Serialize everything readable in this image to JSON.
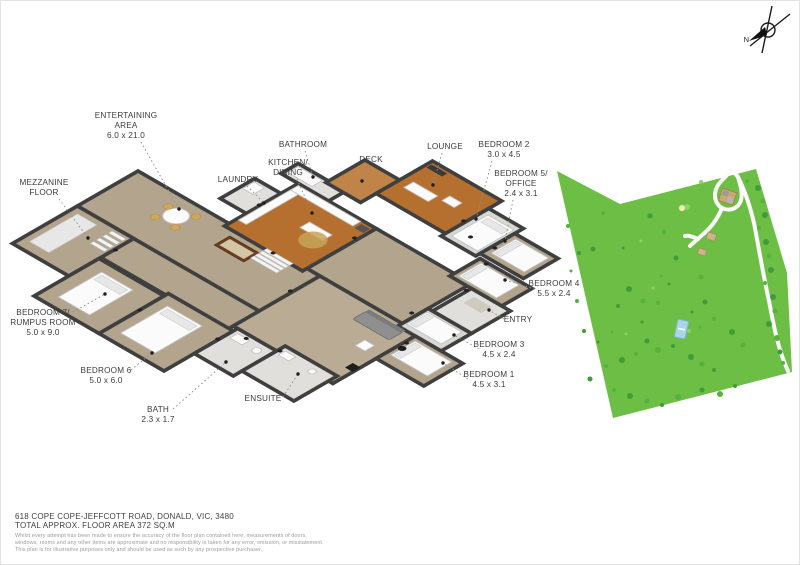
{
  "page": {
    "width": 800,
    "height": 565,
    "background": "#ffffff"
  },
  "compass": {
    "n_label": "N"
  },
  "floor_plan": {
    "labels": [
      {
        "id": "entertaining-area",
        "lines": [
          "ENTERTAINING",
          "AREA",
          "6.0 x 21.0"
        ],
        "x": 125,
        "y": 117,
        "leader": [
          140,
          141,
          178,
          208
        ]
      },
      {
        "id": "mezzanine-floor",
        "lines": [
          "MEZZANINE",
          "FLOOR"
        ],
        "x": 43,
        "y": 184,
        "leader": [
          58,
          198,
          87,
          237
        ]
      },
      {
        "id": "laundry",
        "lines": [
          "LAUNDRY"
        ],
        "x": 237,
        "y": 181,
        "leader": [
          246,
          185,
          263,
          202
        ]
      },
      {
        "id": "bathroom",
        "lines": [
          "BATHROOM"
        ],
        "x": 302,
        "y": 146,
        "leader": [
          304,
          150,
          312,
          176
        ]
      },
      {
        "id": "kitchen-dining",
        "lines": [
          "KITCHEN/",
          "DINING"
        ],
        "x": 287,
        "y": 164,
        "leader": [
          296,
          178,
          311,
          212
        ]
      },
      {
        "id": "deck",
        "lines": [
          "DECK"
        ],
        "x": 370,
        "y": 161,
        "leader": [
          367,
          164,
          361,
          180
        ]
      },
      {
        "id": "lounge",
        "lines": [
          "LOUNGE"
        ],
        "x": 444,
        "y": 148,
        "leader": [
          441,
          152,
          432,
          184
        ]
      },
      {
        "id": "bedroom-2",
        "lines": [
          "BEDROOM 2",
          "3.0 x 4.5"
        ],
        "x": 503,
        "y": 146,
        "leader": [
          491,
          160,
          475,
          218
        ]
      },
      {
        "id": "bedroom-5-office",
        "lines": [
          "BEDROOM 5/",
          "OFFICE",
          "2.4 x 3.1"
        ],
        "x": 520,
        "y": 175,
        "leader": [
          512,
          199,
          504,
          240
        ]
      },
      {
        "id": "bedroom-4",
        "lines": [
          "BEDROOM 4",
          "5.5 x 2.4"
        ],
        "x": 553,
        "y": 285,
        "leader": [
          534,
          288,
          504,
          279
        ]
      },
      {
        "id": "entry",
        "lines": [
          "ENTRY"
        ],
        "x": 517,
        "y": 321,
        "leader": [
          503,
          318,
          488,
          309
        ]
      },
      {
        "id": "bedroom-3",
        "lines": [
          "BEDROOM 3",
          "4.5 x 2.4"
        ],
        "x": 498,
        "y": 346,
        "leader": [
          478,
          348,
          453,
          334
        ]
      },
      {
        "id": "bedroom-1",
        "lines": [
          "BEDROOM 1",
          "4.5 x 3.1"
        ],
        "x": 488,
        "y": 376,
        "leader": [
          467,
          378,
          442,
          362
        ]
      },
      {
        "id": "bedroom-7-rumpus",
        "lines": [
          "BEDROOM 7/",
          "RUMPUS ROOM",
          "5.0 x 9.0"
        ],
        "x": 42,
        "y": 314,
        "leader": [
          72,
          311,
          104,
          293
        ]
      },
      {
        "id": "bedroom-6",
        "lines": [
          "BEDROOM 6",
          "5.0 x 6.0"
        ],
        "x": 105,
        "y": 372,
        "leader": [
          130,
          369,
          151,
          352
        ]
      },
      {
        "id": "bath",
        "lines": [
          "BATH",
          "2.3 x 1.7"
        ],
        "x": 157,
        "y": 411,
        "leader": [
          172,
          408,
          225,
          361
        ]
      },
      {
        "id": "ensuite",
        "lines": [
          "ENSUITE"
        ],
        "x": 262,
        "y": 400,
        "leader": [
          282,
          396,
          297,
          373
        ]
      }
    ],
    "door_markers": [
      [
        208,
        62
      ],
      [
        160,
        34
      ],
      [
        104,
        -6
      ],
      [
        192,
        -28
      ],
      [
        300,
        14
      ],
      [
        327,
        47
      ],
      [
        258,
        -96
      ],
      [
        283,
        -99
      ],
      [
        140,
        168
      ],
      [
        214,
        152
      ],
      [
        66,
        122
      ],
      [
        309,
        -40
      ],
      [
        294,
        -78
      ],
      [
        238,
        -108
      ],
      [
        230,
        135
      ],
      [
        262,
        128
      ]
    ]
  },
  "site_map": {
    "lot_outline": "556,170 619,203 755,168 786,272 791,371 612,417",
    "tree_colors": [
      "#3f9c38",
      "#55b23d",
      "#8ed06a"
    ],
    "trees": [
      [
        757,
        187,
        3,
        0
      ],
      [
        762,
        200,
        2.5,
        1
      ],
      [
        764,
        214,
        3,
        0
      ],
      [
        758,
        227,
        2,
        1
      ],
      [
        765,
        241,
        3,
        0
      ],
      [
        768,
        255,
        2.5,
        1
      ],
      [
        770,
        269,
        3,
        0
      ],
      [
        764,
        282,
        2,
        1
      ],
      [
        772,
        296,
        3,
        0
      ],
      [
        774,
        310,
        2.5,
        1
      ],
      [
        768,
        323,
        3,
        0
      ],
      [
        776,
        337,
        3,
        1
      ],
      [
        779,
        351,
        2.5,
        0
      ],
      [
        782,
        362,
        2,
        1
      ],
      [
        746,
        180,
        2,
        1
      ],
      [
        700,
        181,
        2,
        2
      ],
      [
        686,
        206,
        3,
        2
      ],
      [
        649,
        215,
        2.5,
        0
      ],
      [
        663,
        231,
        2,
        1
      ],
      [
        675,
        257,
        2.5,
        0
      ],
      [
        602,
        212,
        2,
        1
      ],
      [
        592,
        248,
        2.5,
        0
      ],
      [
        567,
        225,
        2,
        1
      ],
      [
        578,
        252,
        2,
        0
      ],
      [
        700,
        276,
        2.5,
        1
      ],
      [
        640,
        240,
        1.5,
        2
      ],
      [
        622,
        247,
        1.5,
        0
      ],
      [
        628,
        288,
        3,
        0
      ],
      [
        642,
        300,
        2.5,
        1
      ],
      [
        617,
        305,
        2,
        0
      ],
      [
        657,
        302,
        2,
        1
      ],
      [
        704,
        301,
        2.5,
        0
      ],
      [
        713,
        318,
        2,
        1
      ],
      [
        731,
        331,
        3,
        0
      ],
      [
        742,
        344,
        2.5,
        1
      ],
      [
        688,
        330,
        2,
        2
      ],
      [
        672,
        345,
        2,
        0
      ],
      [
        660,
        275,
        1.5,
        1
      ],
      [
        668,
        283,
        1.5,
        0
      ],
      [
        652,
        287,
        1.5,
        2
      ],
      [
        691,
        311,
        1.5,
        0
      ],
      [
        699,
        326,
        1.5,
        1
      ],
      [
        641,
        321,
        1.5,
        0
      ],
      [
        611,
        331,
        1.5,
        1
      ],
      [
        597,
        341,
        1.5,
        0
      ],
      [
        625,
        333,
        1.5,
        2
      ],
      [
        690,
        356,
        3,
        0
      ],
      [
        701,
        363,
        2.5,
        1
      ],
      [
        713,
        369,
        2,
        0
      ],
      [
        657,
        349,
        3,
        1
      ],
      [
        646,
        340,
        2.5,
        0
      ],
      [
        635,
        353,
        2,
        1
      ],
      [
        621,
        359,
        3,
        0
      ],
      [
        605,
        365,
        2,
        1
      ],
      [
        589,
        378,
        2.5,
        0
      ],
      [
        613,
        389,
        2,
        1
      ],
      [
        629,
        395,
        3,
        0
      ],
      [
        646,
        400,
        2.5,
        1
      ],
      [
        661,
        404,
        2,
        0
      ],
      [
        677,
        396,
        3,
        1
      ],
      [
        701,
        389,
        2.5,
        0
      ],
      [
        719,
        393,
        3,
        1
      ],
      [
        734,
        385,
        2,
        0
      ],
      [
        576,
        300,
        2,
        1
      ],
      [
        583,
        330,
        2,
        0
      ],
      [
        570,
        270,
        1.5,
        1
      ]
    ]
  },
  "footer": {
    "address": "618 COPE COPE-JEFFCOTT ROAD, DONALD, VIC, 3480",
    "floor_area": "TOTAL APPROX. FLOOR AREA 372 SQ.M",
    "disclaimer_lines": [
      "Whilst every attempt has been made to ensure the accuracy of the floor plan contained here, measurements of doors,",
      "windows, rooms and any other items are approximate and no responsibility is taken for any error, omission, or misstatement.",
      "This plan is for illustrative purposes only and should be used as such by any prospective purchaser."
    ]
  },
  "colors": {
    "floor_tan": "#b3a48d",
    "floor_tan_light": "#b9ab94",
    "floor_wood": "#b5702f",
    "floor_wood_light": "#c08449",
    "floor_gray": "#e0dfdb",
    "floor_gray_bed": "#d8d7d2",
    "wall": "#3f3f3f",
    "lot_green": "#6dbe45",
    "road": "#fcfcfc",
    "pool_blue": "#aad6ea",
    "label_text": "#3c3c3c"
  }
}
